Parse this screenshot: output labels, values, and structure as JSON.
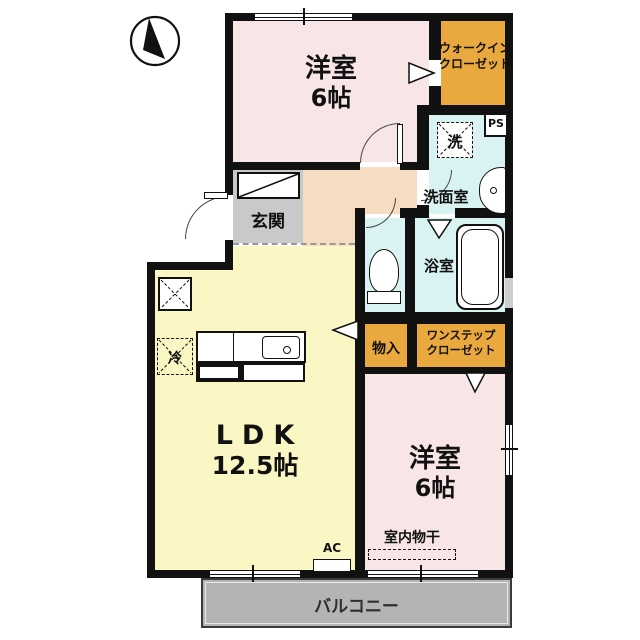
{
  "plan_title": "apartment-floor-plan",
  "compass": {
    "icon": "north-arrow"
  },
  "rooms": {
    "bedroom_top": {
      "name": "洋室",
      "size": "6帖"
    },
    "walkin_closet": {
      "line1": "ウォークイン",
      "line2": "クローゼット"
    },
    "pipe_space": {
      "label": "PS"
    },
    "laundry": {
      "label": "洗"
    },
    "washroom": {
      "label": "洗面室"
    },
    "bathroom": {
      "label": "浴室"
    },
    "entrance": {
      "label": "玄関"
    },
    "ldk": {
      "name": "LDK",
      "size": "12.5帖"
    },
    "fridge": {
      "label": "冷"
    },
    "storage": {
      "label": "物入"
    },
    "onestep_closet": {
      "line1": "ワンステップ",
      "line2": "クローゼット"
    },
    "bedroom_bottom": {
      "name": "洋室",
      "size": "6帖"
    },
    "indoor_drying": {
      "label": "室内物干"
    },
    "air_conditioner": {
      "label": "AC"
    },
    "balcony": {
      "label": "バルコニー"
    }
  },
  "colors": {
    "bedroom": "#f8e6e6",
    "closet": "#eaa93e",
    "wet_area": "#d9f3f3",
    "hallway": "#f6dcc0",
    "ldk": "#fbf7c4",
    "entrance": "#c9c9c9",
    "balcony": "#b4b4b4",
    "wall": "#111111"
  }
}
